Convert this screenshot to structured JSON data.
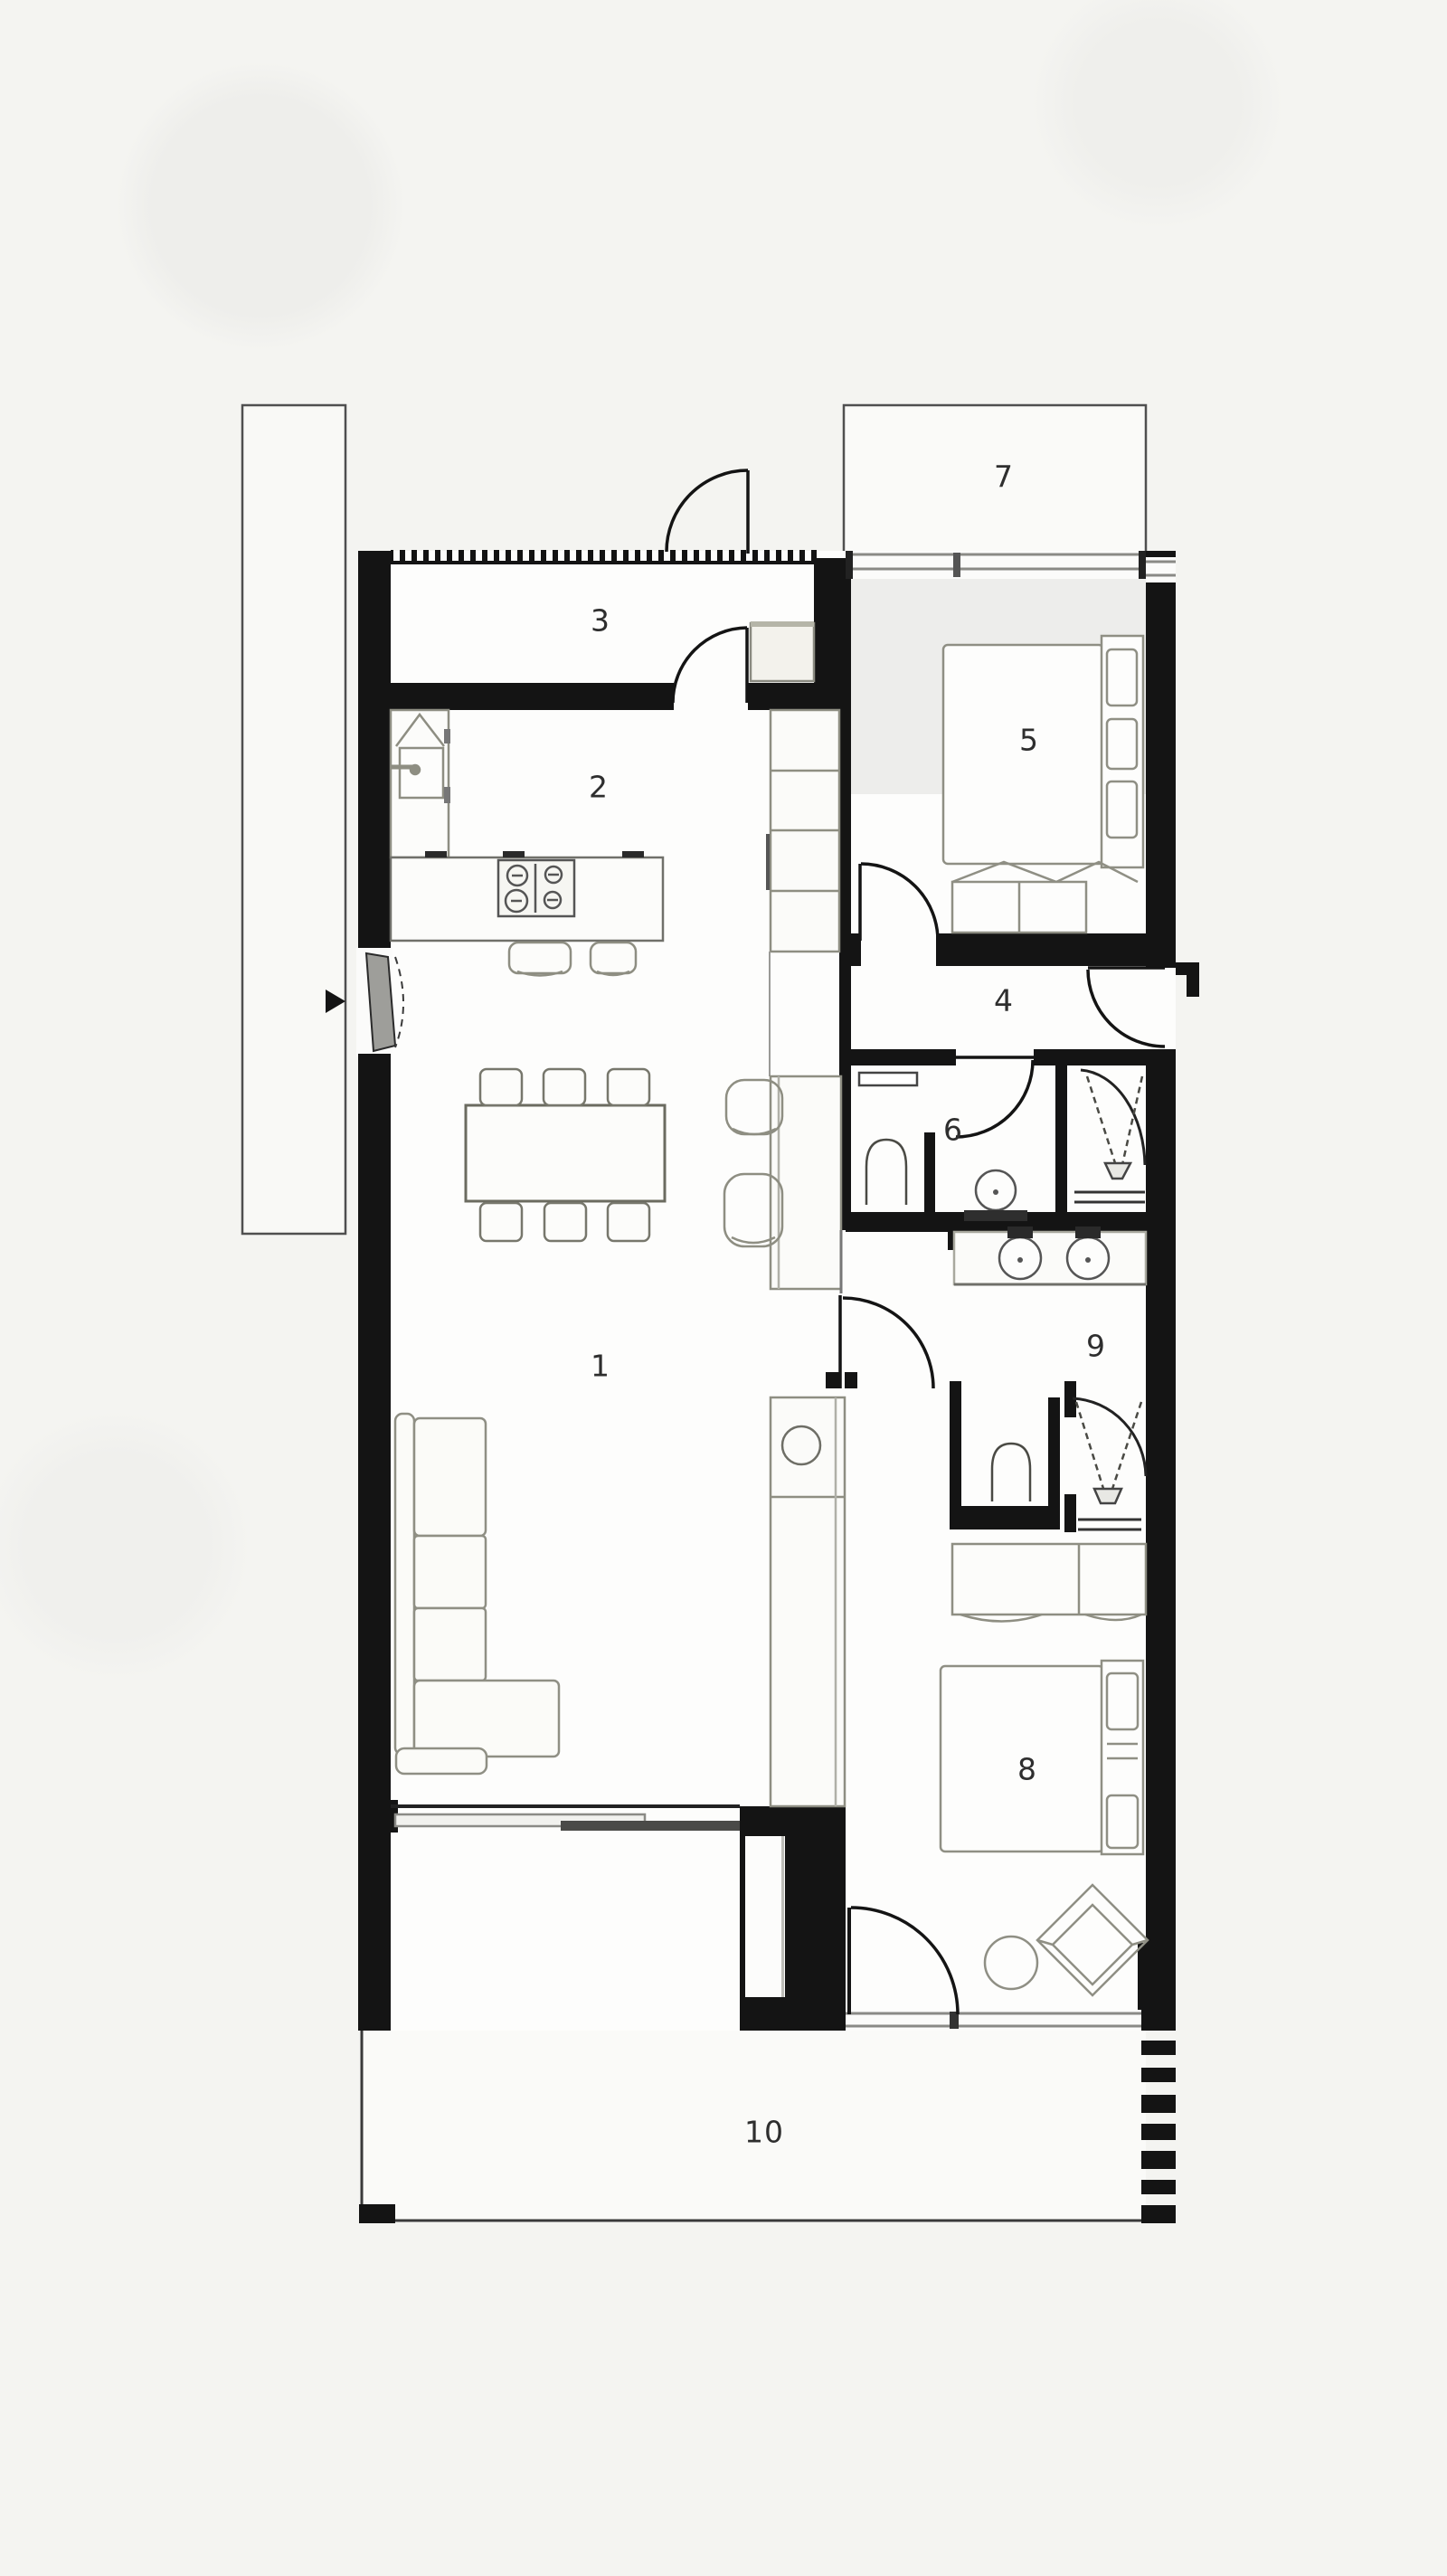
{
  "plan": {
    "type": "floor-plan",
    "rooms": [
      {
        "key": "living-area",
        "label": "1"
      },
      {
        "key": "kitchen",
        "label": "2"
      },
      {
        "key": "entry-storage",
        "label": "3"
      },
      {
        "key": "hallway",
        "label": "4"
      },
      {
        "key": "bedroom-upper",
        "label": "5"
      },
      {
        "key": "bathroom",
        "label": "6"
      },
      {
        "key": "balcony",
        "label": "7"
      },
      {
        "key": "bedroom-lower",
        "label": "8"
      },
      {
        "key": "ensuite-bathroom",
        "label": "9"
      },
      {
        "key": "terrace",
        "label": "10"
      }
    ],
    "colors": {
      "wall": "#141414",
      "floor": "#fdfdfc",
      "exterior_floor": "#fafaf8",
      "furniture_stroke": "#8e8e82",
      "fixture_stroke": "#4a4a44",
      "glass_frame": "#8a8a86",
      "door_leaf": "#9e9e9a",
      "label_text": "#2e2e2e",
      "background": "#f4f4f1"
    },
    "icons": {
      "entry_arrow": "entry-direction-arrow"
    }
  }
}
